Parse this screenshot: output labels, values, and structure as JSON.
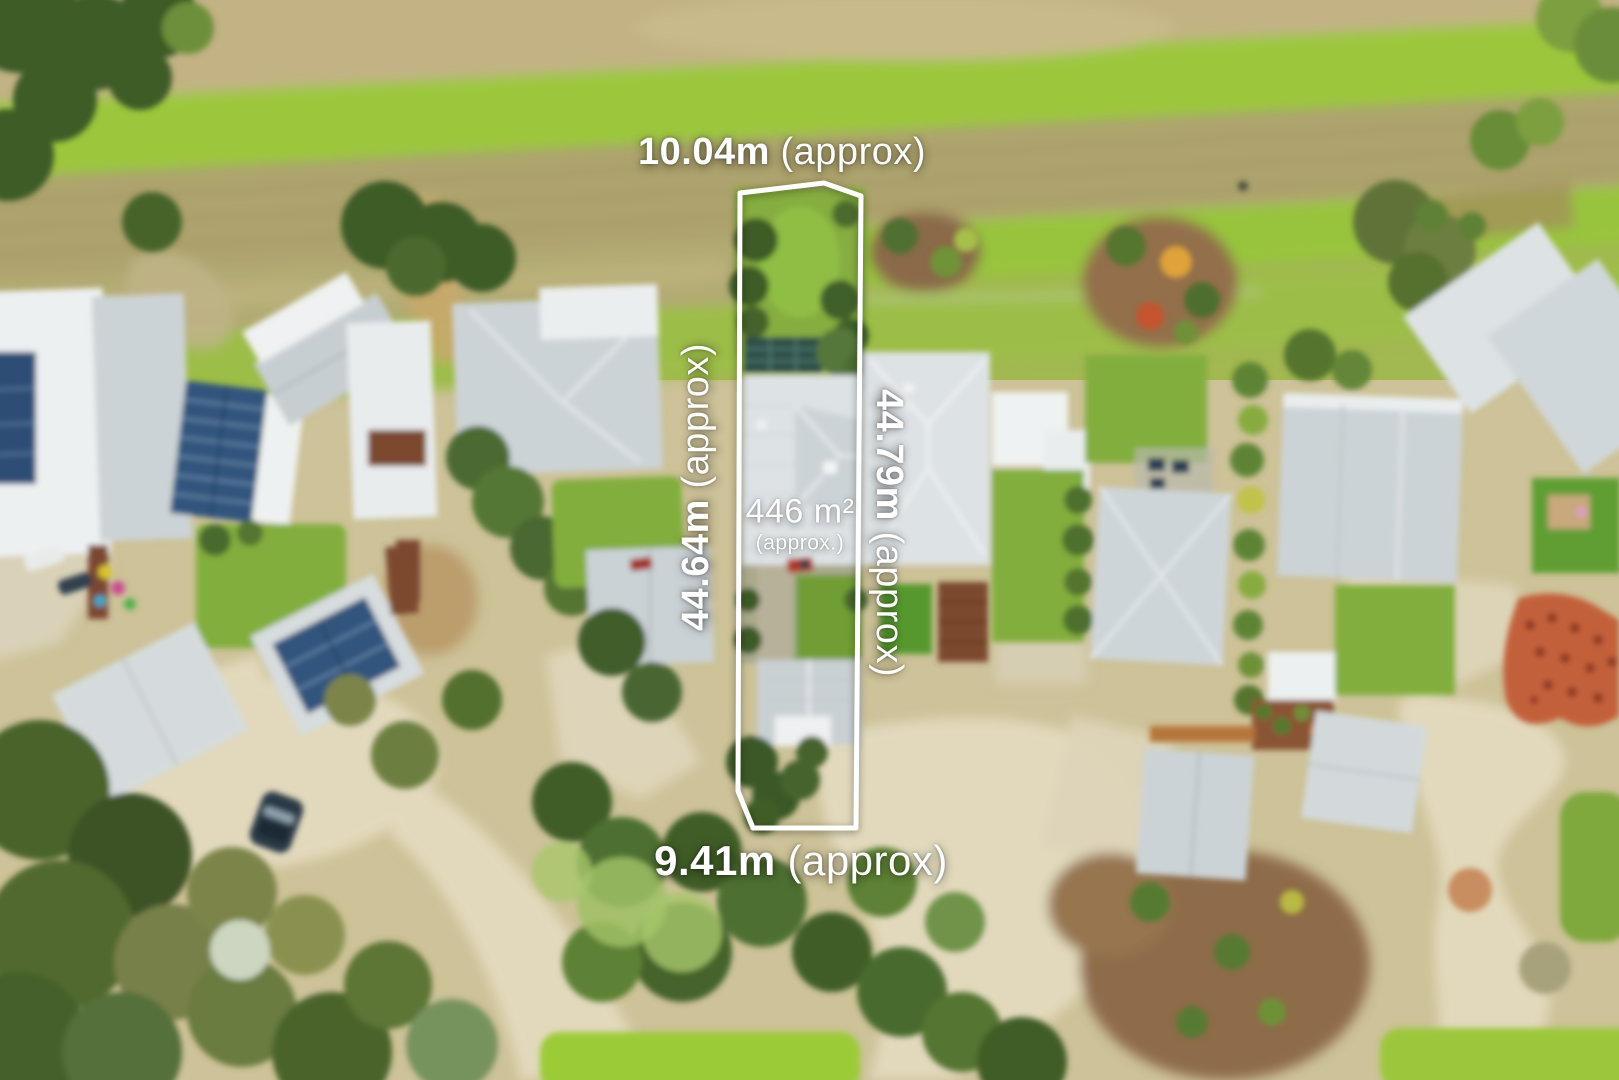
{
  "photo": {
    "description": "Aerial drone photograph of a residential neighbourhood with a narrow vacant lot outlined for sale",
    "labels": {
      "area_value": "446 m²",
      "area_qualifier": "(approx.)",
      "top_value": "10.04m",
      "top_qualifier": "(approx)",
      "bottom_value": "9.41m",
      "bottom_qualifier": "(approx)",
      "left_value": "44.64m",
      "left_qualifier": "(approx)",
      "right_value": "44.79m",
      "right_qualifier": "(approx)"
    }
  },
  "palette": {
    "boundary_stroke": "#ffffff",
    "park_grass": "#a2b851",
    "park_grass_bright": "#9cc73e",
    "park_grass_olive": "#aba06a",
    "dirt_path": "#c2b284",
    "tree_dark": "#3f5c28",
    "roof_light": "#dde2e4",
    "roof_mid": "#ccd3d6",
    "roof_white": "#edf0f1",
    "solar_panel": "#33557d",
    "solar_teal": "#2e4f49",
    "lawn_green": "#82ae3d",
    "road_concrete": "#e2d9bd",
    "mulch_brown": "#8e6c4a",
    "paving_red": "#c2603a",
    "rust_deck": "#7c4a2e",
    "car_dark": "#2b3a46"
  }
}
